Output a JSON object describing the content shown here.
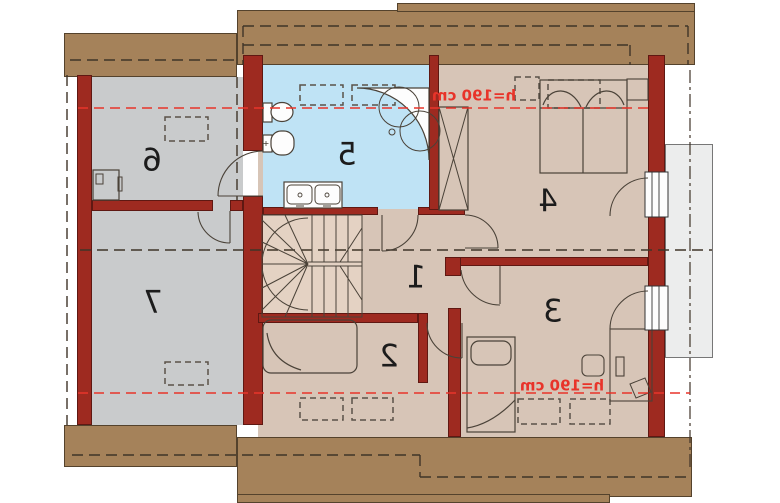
{
  "plan": {
    "type": "floor-plan",
    "level": "attic",
    "rooms": [
      {
        "number": "1"
      },
      {
        "number": "2"
      },
      {
        "number": "3"
      },
      {
        "number": "4"
      },
      {
        "number": "5"
      },
      {
        "number": "6"
      },
      {
        "number": "7"
      }
    ],
    "annotations": {
      "ceiling_height_top": "h=190 cm",
      "ceiling_height_bottom": "h=190 cm"
    },
    "fixtures": [
      "toilet",
      "bidet",
      "corner-bathtub",
      "double-sink",
      "winder-stairs",
      "double-bed",
      "single-bed",
      "sofa-bed",
      "desk",
      "desk-chair",
      "water-heater",
      "chimney-shaft",
      "balcony",
      "skylight"
    ],
    "colors": {
      "roof": "#a5825a",
      "wall": "#9e2a20",
      "room_gray": "#c9cbcc",
      "room_tan": "#d7c5b7",
      "bathroom_blue": "#bfe3f5",
      "stairs": "#e4d2c3",
      "balcony": "#eceded",
      "height_line": "#e8342a"
    }
  }
}
